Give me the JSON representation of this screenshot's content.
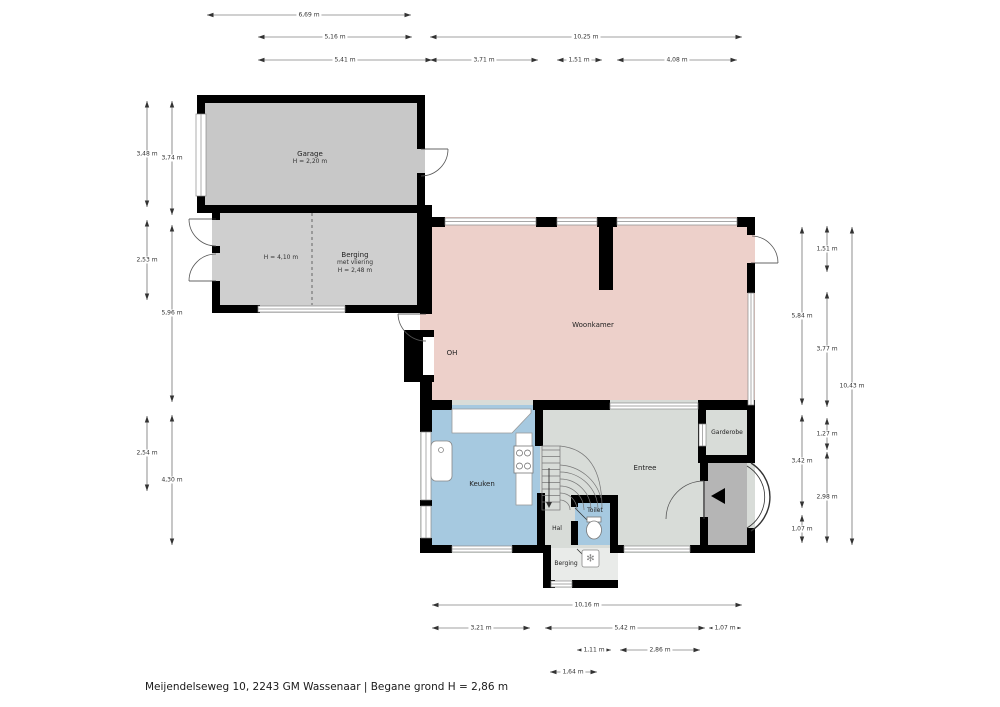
{
  "plan": {
    "caption": "Meijendelseweg 10, 2243 GM Wassenaar | Begane grond H = 2,86 m"
  },
  "rooms": {
    "garage": {
      "name": "Garage",
      "height": "H = 2,20 m"
    },
    "berging": {
      "name": "Berging",
      "note": "met vliering",
      "height": "H = 2,48 m",
      "zone_height": "H = 4,10 m"
    },
    "woonkamer": {
      "name": "Woonkamer",
      "fireplace": "OH"
    },
    "keuken": {
      "name": "Keuken"
    },
    "entree": {
      "name": "Entree"
    },
    "garderobe": {
      "name": "Garderobe"
    },
    "hal": {
      "name": "Hal"
    },
    "toilet": {
      "name": "Toilet"
    },
    "berging_klein": {
      "name": "Berging"
    }
  },
  "icons": {
    "ventilation": "✻"
  },
  "dims": {
    "top": {
      "d1": "6,69 m",
      "d2": "5,16 m",
      "d3": "10,25 m",
      "d4": "5,41 m",
      "d5": "3,71 m",
      "d6": "1,51 m",
      "d7": "4,08 m"
    },
    "left": {
      "d1": "3,48 m",
      "d2": "2,53 m",
      "d3": "2,54 m",
      "d4": "3,74 m",
      "d5": "5,96 m",
      "d6": "4,30 m"
    },
    "right": {
      "d1": "5,84 m",
      "d2": "3,42 m",
      "d3": "1,07 m",
      "d4": "1,51 m",
      "d5": "3,77 m",
      "d6": "1,27 m",
      "d7": "2,98 m",
      "d8": "10,43 m"
    },
    "bottom": {
      "d1": "10,16 m",
      "d2": "3,21 m",
      "d3": "5,42 m",
      "d4": "1,07 m",
      "d5": "1,11 m",
      "d6": "2,86 m",
      "d7": "1,64 m"
    }
  },
  "colors": {
    "woonkamer": "#edd0ca",
    "keuken": "#a6c9e0",
    "garage": "#c8c8c8",
    "berging": "#cfcfcf",
    "entree": "#d8dcd8",
    "berging_klein": "#e9ebe9",
    "porch": "#b5b5b5",
    "wall": "#000000"
  }
}
